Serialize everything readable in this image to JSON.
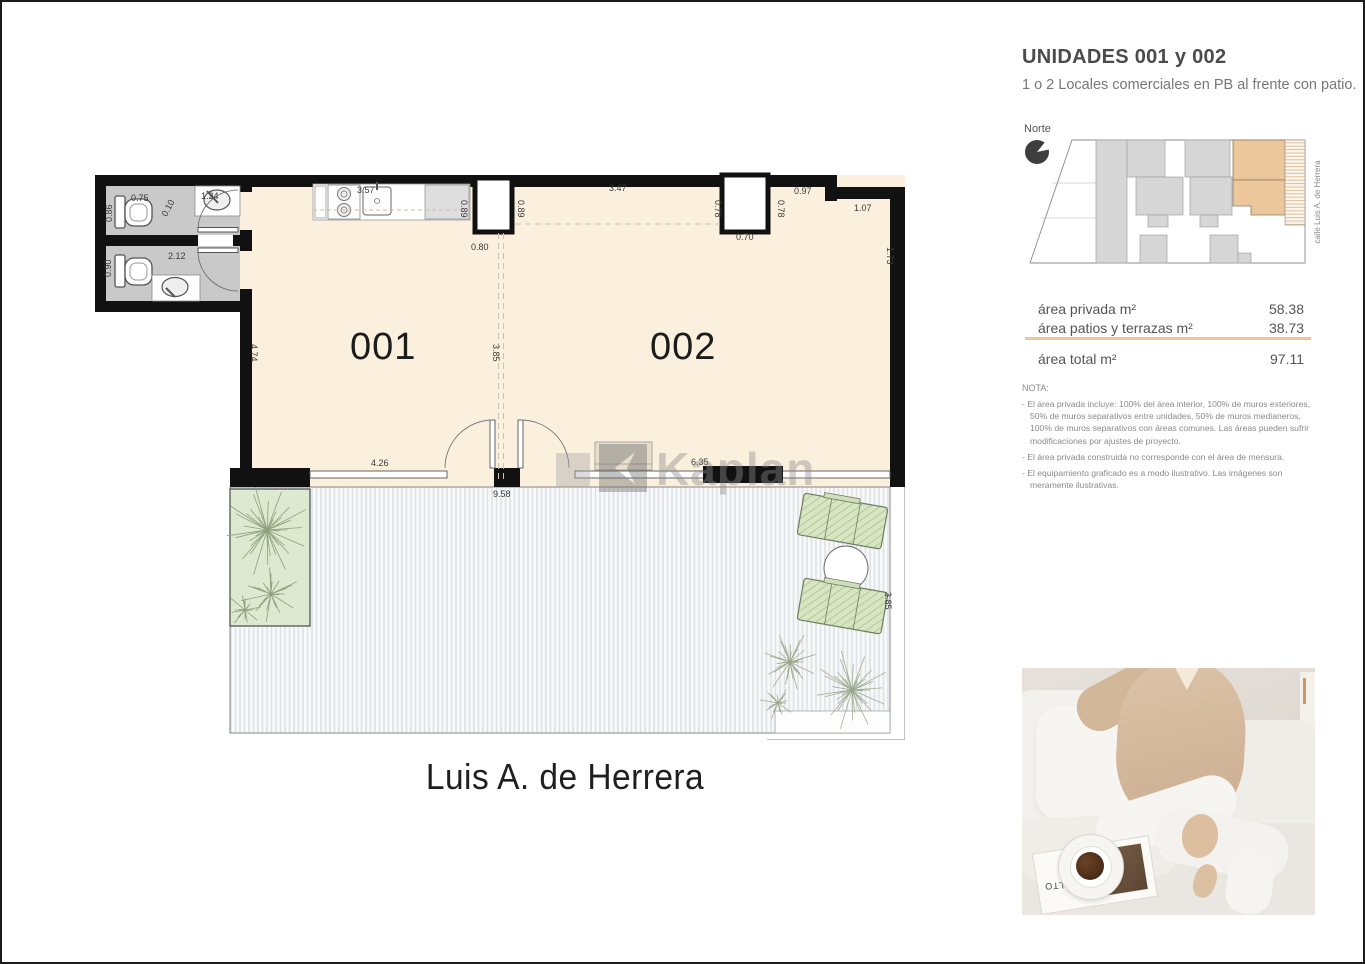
{
  "right_panel": {
    "title": "UNIDADES 001 y 002",
    "subtitle": "1 o 2 Locales comerciales en PB al frente con patio.",
    "north_label": "Norte",
    "street_label": "calle Luis A. de Herrera",
    "area_table": {
      "rows": [
        {
          "label": "área privada m²",
          "value": "58.38"
        },
        {
          "label": "área patios y terrazas m²",
          "value": "38.73"
        }
      ],
      "total_label": "área total m²",
      "total_value": "97.11"
    },
    "nota_title": "NOTA:",
    "nota_items": [
      "- El área privada incluye: 100% del área interior, 100% de muros exteriores, 50% de muros separativos entre unidades, 50% de muros medianeros, 100% de muros separativos con áreas comunes. Las áreas pueden sufrir modificaciones por ajustes de proyecto.",
      "- El área privada construida no corresponde con el área de mensura.",
      "- El equipamiento graficado es a modo ilustrativo. Las imágenes son meramente ilustrativas."
    ],
    "photo": {
      "magazine_text": "AALTO"
    }
  },
  "plan": {
    "unit1_label": "001",
    "unit2_label": "002",
    "street_title": "Luis A. de Herrera",
    "dims": {
      "d_075": "0.75",
      "d_086": "0.86",
      "d_010": "0.10",
      "d_124": "1.24",
      "d_212": "2.12",
      "d_090": "0.90",
      "d_357": "3.57",
      "d_089a": "0.89",
      "d_089b": "0.89",
      "d_080": "0.80",
      "d_347": "3.47",
      "d_078a": "0.78",
      "d_078b": "0.78",
      "d_070": "0.70",
      "d_097": "0.97",
      "d_107": "1.07",
      "d_173": "1.73",
      "d_474": "4.74",
      "d_385a": "3.85",
      "d_426": "4.26",
      "d_958": "9.58",
      "d_635": "6.35",
      "d_385b": "3.85"
    }
  },
  "watermark": {
    "text": "Kaplan"
  },
  "colors": {
    "wall_black": "#111111",
    "room_cream": "#fbf0dd",
    "bath_gray": "#c9c9c9",
    "accent_tan": "#ecc795",
    "highlight_unit": "#ecc79b",
    "planter_green": "#dde9d1"
  }
}
